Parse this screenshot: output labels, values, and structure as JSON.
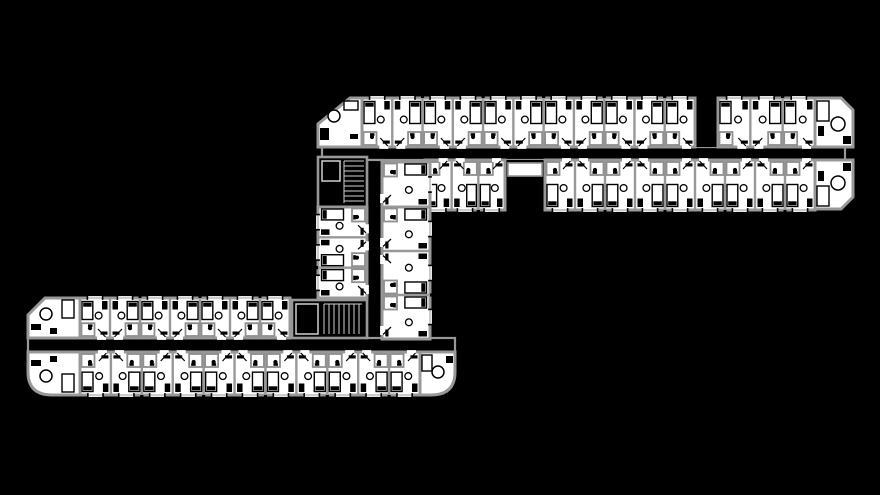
{
  "canvas": {
    "width": 880,
    "height": 495,
    "background": "#000000"
  },
  "palette": {
    "wall": "#989898",
    "wall_light": "#cfcfcf",
    "floor": "#ffffff",
    "ink": "#000000",
    "glass": "#9a9a9a",
    "pod_wall": "#8f8f8f"
  },
  "floorplan": {
    "corridors": [
      {
        "id": "north-corridor",
        "x": 322,
        "y": 147,
        "w": 523,
        "h": 13
      },
      {
        "id": "link-corridor",
        "x": 367,
        "y": 160,
        "w": 15,
        "h": 192
      },
      {
        "id": "south-corridor",
        "x": 28,
        "y": 338,
        "w": 427,
        "h": 14
      }
    ],
    "voids": [
      {
        "id": "elevator-lobby",
        "x": 505,
        "y": 160,
        "w": 40,
        "h": 50,
        "cell": {
          "x": 508,
          "y": 163,
          "w": 34,
          "h": 13
        }
      },
      {
        "id": "light-well-niche",
        "x": 695,
        "y": 98,
        "w": 23,
        "h": 49
      }
    ],
    "stairs": [
      {
        "id": "north-stair-block",
        "x": 318,
        "y": 157,
        "w": 49,
        "h": 50,
        "cells": [
          {
            "x": 322,
            "y": 161,
            "w": 18,
            "h": 20
          }
        ],
        "treads": {
          "x": 344,
          "y": 161,
          "w": 20,
          "h": 42,
          "dir": "v",
          "step": 5
        }
      },
      {
        "id": "south-stair-block",
        "x": 292,
        "y": 300,
        "w": 75,
        "h": 38,
        "cells": [
          {
            "x": 296,
            "y": 304,
            "w": 22,
            "h": 30
          }
        ],
        "treads": {
          "x": 324,
          "y": 304,
          "w": 38,
          "h": 30,
          "dir": "h",
          "step": 5
        }
      }
    ],
    "room_rows": [
      {
        "id": "north-wing-top-row-west",
        "x": 362,
        "y": 98,
        "w": 333,
        "h": 49,
        "count": 11,
        "exterior": "n"
      },
      {
        "id": "north-wing-top-row-east",
        "x": 718,
        "y": 98,
        "w": 97,
        "h": 49,
        "count": 3,
        "exterior": "n"
      },
      {
        "id": "north-wing-bottom-row-west",
        "x": 425,
        "y": 160,
        "w": 80,
        "h": 50,
        "count": 3,
        "exterior": "s"
      },
      {
        "id": "north-wing-bottom-row-east",
        "x": 545,
        "y": 160,
        "w": 270,
        "h": 50,
        "count": 9,
        "exterior": "s"
      },
      {
        "id": "link-wing-corner-room",
        "x": 382,
        "y": 162,
        "w": 48,
        "h": 45,
        "count": 1,
        "exterior": "e",
        "vertical": true
      },
      {
        "id": "link-wing-west-column",
        "x": 318,
        "y": 207,
        "w": 49,
        "h": 91,
        "count": 3,
        "exterior": "w",
        "vertical": true
      },
      {
        "id": "link-wing-east-column",
        "x": 382,
        "y": 207,
        "w": 48,
        "h": 132,
        "count": 3,
        "exterior": "e",
        "vertical": true
      },
      {
        "id": "south-wing-top-row",
        "x": 80,
        "y": 298,
        "w": 210,
        "h": 40,
        "count": 7,
        "exterior": "n"
      },
      {
        "id": "south-wing-bottom-row",
        "x": 80,
        "y": 352,
        "w": 340,
        "h": 43,
        "count": 11,
        "exterior": "s"
      }
    ],
    "end_caps": [
      {
        "id": "north-wing-west-cap",
        "d": "M318,147 L318,124 L350,98 L362,98 L362,147 Z",
        "items": [
          {
            "t": "c",
            "x": 334,
            "y": 116,
            "r": 6
          },
          {
            "t": "fr",
            "x": 320,
            "y": 128,
            "w": 9,
            "h": 12
          },
          {
            "t": "sr",
            "x": 344,
            "y": 101,
            "w": 14,
            "h": 9
          },
          {
            "t": "fr",
            "x": 350,
            "y": 134,
            "w": 8,
            "h": 5
          }
        ]
      },
      {
        "id": "north-wing-east-cap-top",
        "d": "M815,98 L841,98 L853,110 L853,147 L815,147 Z",
        "items": [
          {
            "t": "c",
            "x": 838,
            "y": 124,
            "r": 7
          },
          {
            "t": "sr",
            "x": 817,
            "y": 101,
            "w": 12,
            "h": 20
          },
          {
            "t": "fr",
            "x": 843,
            "y": 136,
            "w": 8,
            "h": 8
          },
          {
            "t": "fr",
            "x": 818,
            "y": 126,
            "w": 6,
            "h": 10
          }
        ]
      },
      {
        "id": "north-wing-east-cap-bottom",
        "d": "M815,160 L853,160 L853,197 L841,209 L815,209 Z",
        "items": [
          {
            "t": "c",
            "x": 838,
            "y": 183,
            "r": 7
          },
          {
            "t": "sr",
            "x": 817,
            "y": 186,
            "w": 12,
            "h": 20
          },
          {
            "t": "fr",
            "x": 843,
            "y": 163,
            "w": 8,
            "h": 8
          },
          {
            "t": "fr",
            "x": 818,
            "y": 171,
            "w": 6,
            "h": 10
          }
        ]
      },
      {
        "id": "south-wing-west-cap-top",
        "d": "M28,338 L28,315 L45,298 L80,298 L80,338 Z",
        "items": [
          {
            "t": "c",
            "x": 46,
            "y": 314,
            "r": 6
          },
          {
            "t": "sr",
            "x": 62,
            "y": 300,
            "w": 12,
            "h": 18
          },
          {
            "t": "fr",
            "x": 31,
            "y": 324,
            "w": 10,
            "h": 6
          },
          {
            "t": "fr",
            "x": 50,
            "y": 328,
            "w": 7,
            "h": 6
          }
        ]
      },
      {
        "id": "south-wing-west-cap-bottom",
        "d": "M28,352 L80,352 L80,395 L52,395 Q28,395 28,372 Z",
        "items": [
          {
            "t": "c",
            "x": 46,
            "y": 376,
            "r": 6
          },
          {
            "t": "sr",
            "x": 62,
            "y": 374,
            "w": 12,
            "h": 18
          },
          {
            "t": "fr",
            "x": 31,
            "y": 360,
            "w": 10,
            "h": 6
          },
          {
            "t": "fr",
            "x": 50,
            "y": 356,
            "w": 7,
            "h": 6
          }
        ]
      },
      {
        "id": "south-wing-east-cap",
        "d": "M420,352 L455,352 L455,372 Q455,395 431,395 L420,395 Z",
        "items": [
          {
            "t": "c",
            "x": 438,
            "y": 372,
            "r": 6
          },
          {
            "t": "sr",
            "x": 422,
            "y": 355,
            "w": 10,
            "h": 16
          },
          {
            "t": "fr",
            "x": 446,
            "y": 356,
            "w": 7,
            "h": 7
          }
        ]
      }
    ]
  }
}
